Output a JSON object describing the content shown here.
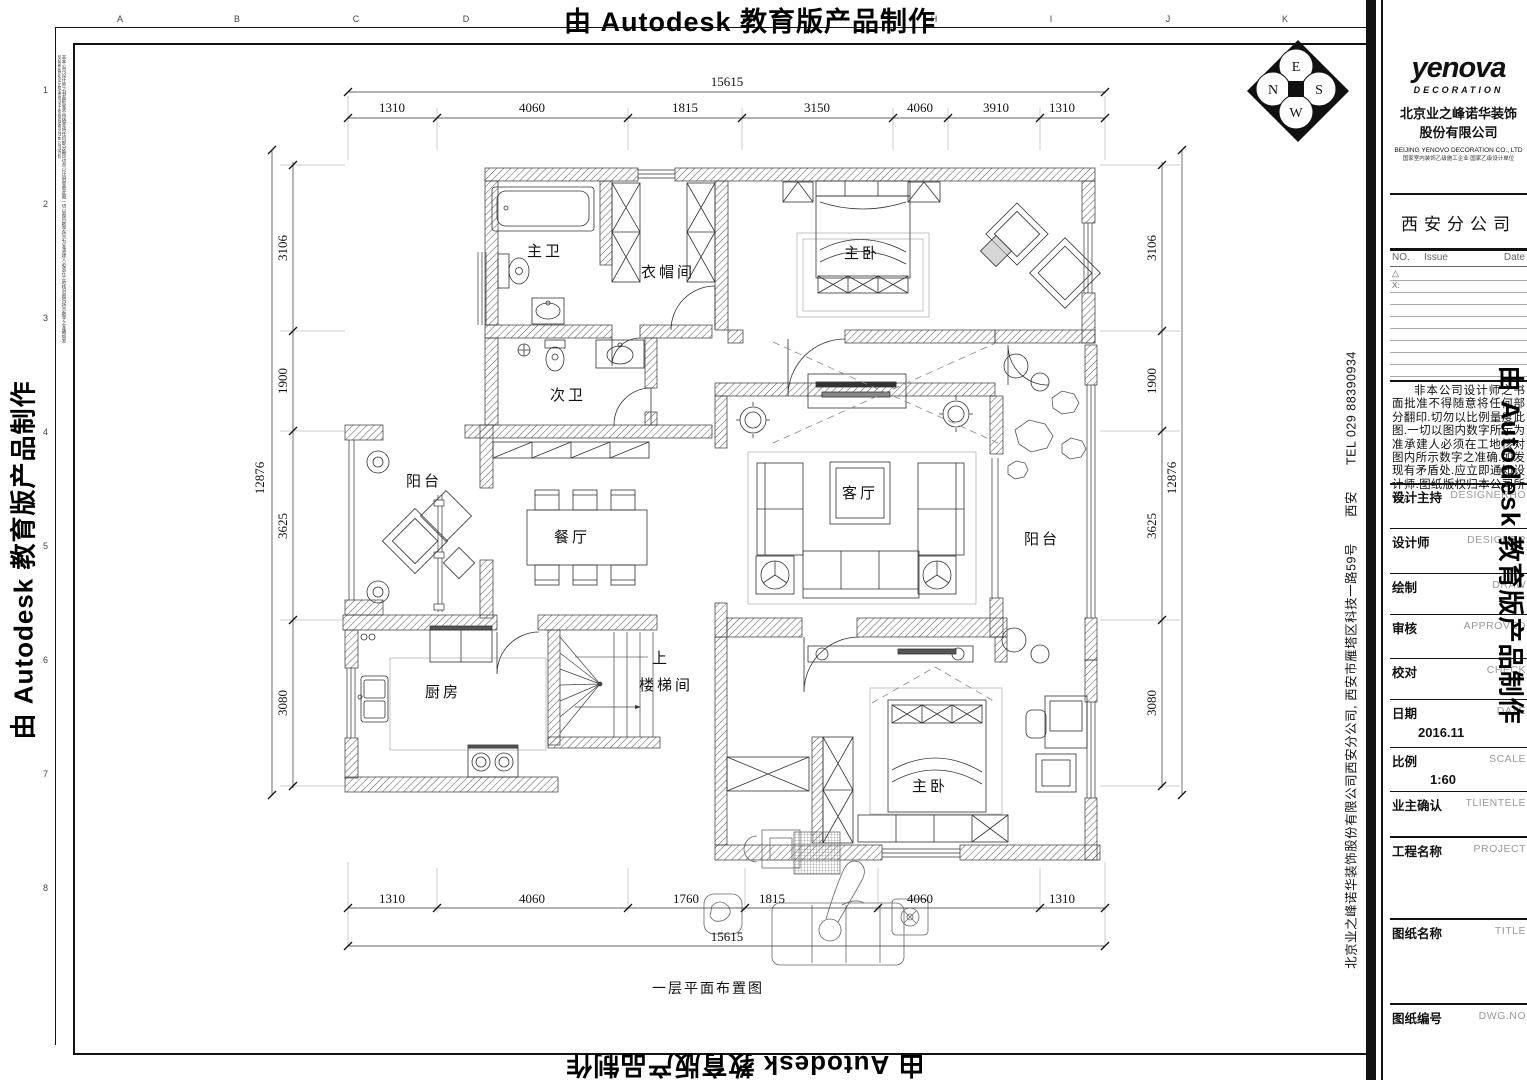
{
  "watermark": {
    "text": "由 Autodesk 教育版产品制作"
  },
  "frame": {
    "top_letters": [
      "A",
      "B",
      "C",
      "D",
      "H",
      "I",
      "J",
      "K"
    ],
    "side_numbers": [
      "1",
      "2",
      "3",
      "4",
      "5",
      "6",
      "7",
      "8"
    ],
    "margin_note": "非本公司设计师之书面批准不得随意将任何部分翻印切勿以比例量度此图一切以图内数字所示为准承建人必须在工地核对图内所示数字之准确如发现有矛盾处应立即通知设计师图纸版权归本公司所有"
  },
  "compass": {
    "n": "N",
    "e": "E",
    "s": "S",
    "w": "W"
  },
  "plan": {
    "title": "一层平面布置图",
    "rooms": {
      "master_bath": "主卫",
      "cloakroom": "衣帽间",
      "master_bedroom_top": "主卧",
      "second_bath": "次卫",
      "balcony_left": "阳台",
      "dining": "餐厅",
      "living": "客厅",
      "balcony_right": "阳台",
      "kitchen": "厨房",
      "stair_up": "上",
      "stairwell": "楼梯间",
      "master_bedroom_bottom": "主卧"
    },
    "dims": {
      "top_total": "15615",
      "top_segments": [
        "1310",
        "4060",
        "1815",
        "3150",
        "4060",
        "3910",
        "1310"
      ],
      "bottom_segments": [
        "1310",
        "4060",
        "1760",
        "1815",
        "4060",
        "1310"
      ],
      "bottom_total": "15615",
      "left_total": "12876",
      "left_segments": [
        "3106",
        "1900",
        "3625",
        "3080"
      ],
      "right_total": "12876",
      "right_segments": [
        "3106",
        "1900",
        "3625",
        "3080"
      ]
    }
  },
  "titleblock": {
    "brand": "yenova",
    "brand_sub": "DECORATION",
    "company_cn_1": "北京业之峰诺华装饰",
    "company_cn_2": "股份有限公司",
    "company_en": "BEIJING YENOVO DECORATION CO., LTD",
    "company_cert": "国家室内装饰乙级施工企业 国家乙级设计单位",
    "branch": "西安分公司",
    "issue_header": {
      "no": "NO.",
      "issue": "Issue",
      "date": "Date",
      "x": "X:",
      "warn": "△"
    },
    "disclaimer": "非本公司设计师之书面批准不得随意将任何部分翻印.切勿以比例量度此图.一切以图内数字所示为准承建人必须在工地核对图内所示数字之准确.如发现有矛盾处.应立即通知设计师.图纸版权归本公司所有。",
    "fields": [
      {
        "cn": "设计主持",
        "en": "DESIGNERHO",
        "value": ""
      },
      {
        "cn": "设计师",
        "en": "DESIGNER",
        "value": ""
      },
      {
        "cn": "绘制",
        "en": "DRAW",
        "value": ""
      },
      {
        "cn": "审核",
        "en": "APPROVED",
        "value": ""
      },
      {
        "cn": "校对",
        "en": "CHECK",
        "value": ""
      },
      {
        "cn": "日期",
        "en": "DATE",
        "value": "2016.11"
      },
      {
        "cn": "比例",
        "en": "SCALE",
        "value": "1:60"
      },
      {
        "cn": "业主确认",
        "en": "TLIENTELE",
        "value": ""
      },
      {
        "cn": "工程名称",
        "en": "PROJECT",
        "value": ""
      },
      {
        "cn": "图纸名称",
        "en": "TITLE",
        "value": ""
      },
      {
        "cn": "图纸编号",
        "en": "DWG.NO",
        "value": ""
      }
    ],
    "side_address": "北京业之峰诺华装饰股份有限公司西安分公司, 西安市雁塔区科技一路59号　　西安　　TEL 029 88390934"
  }
}
